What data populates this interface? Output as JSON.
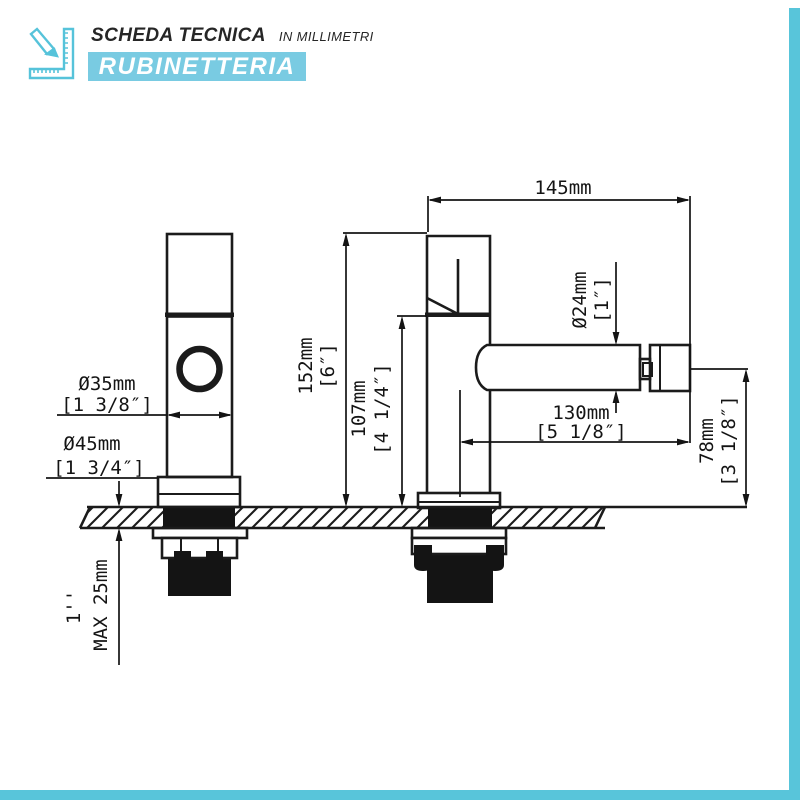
{
  "header": {
    "title": "SCHEDA TECNICA",
    "subtitle": "IN MILLIMETRI",
    "banner": "RUBINETTERIA"
  },
  "colors": {
    "banner_blue": "#79cbe2",
    "frame_blue": "#58c5da",
    "line_black": "#141414"
  },
  "drawing": {
    "views": [
      "front view tap",
      "side view tap"
    ],
    "dimensions": {
      "total_width": {
        "mm": "145mm"
      },
      "spout_diameter": {
        "mm": "Ø24mm",
        "in": "[1″]"
      },
      "total_height": {
        "mm": "152mm",
        "in": "[6″]"
      },
      "spout_height": {
        "mm": "107mm",
        "in": "[4 1/4″]"
      },
      "spout_reach": {
        "mm": "130mm",
        "in": "[5 1/8″]"
      },
      "spout_to_counter": {
        "mm": "78mm",
        "in": "[3 1/8″]"
      },
      "body_diameter": {
        "mm": "Ø35mm",
        "in": "[1 3/8″]"
      },
      "base_diameter": {
        "mm": "Ø45mm",
        "in": "[1 3/4″]"
      },
      "counter_thickness": {
        "label": "MAX 25mm"
      },
      "thread_size": {
        "label": "1''"
      }
    }
  }
}
